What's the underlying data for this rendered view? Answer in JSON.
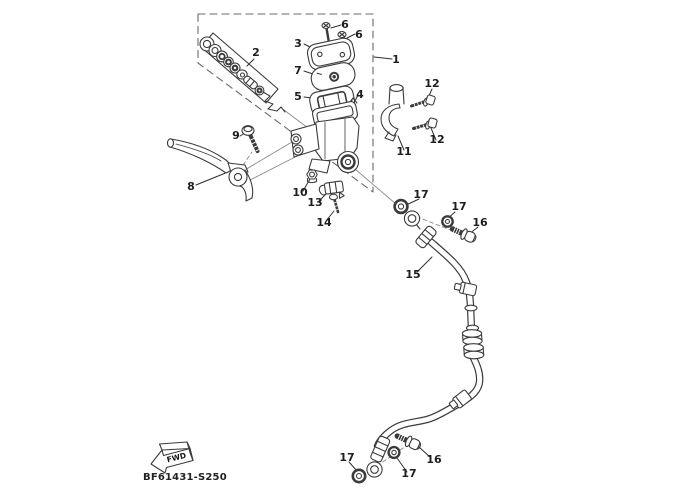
{
  "diagram": {
    "drawing_code": "BF61431-S250",
    "fwd_label": "FWD",
    "line_color": "#3b3b3b",
    "background_color": "#ffffff",
    "callouts": {
      "c1": "1",
      "c2": "2",
      "c3": "3",
      "c4": "4",
      "c5": "5",
      "c6a": "6",
      "c6b": "6",
      "c7": "7",
      "c8": "8",
      "c9": "9",
      "c10": "10",
      "c11": "11",
      "c12a": "12",
      "c12b": "12",
      "c13": "13",
      "c14": "14",
      "c15": "15",
      "c16a": "16",
      "c16b": "16",
      "c17a": "17",
      "c17b": "17",
      "c17c": "17",
      "c17d": "17"
    }
  }
}
